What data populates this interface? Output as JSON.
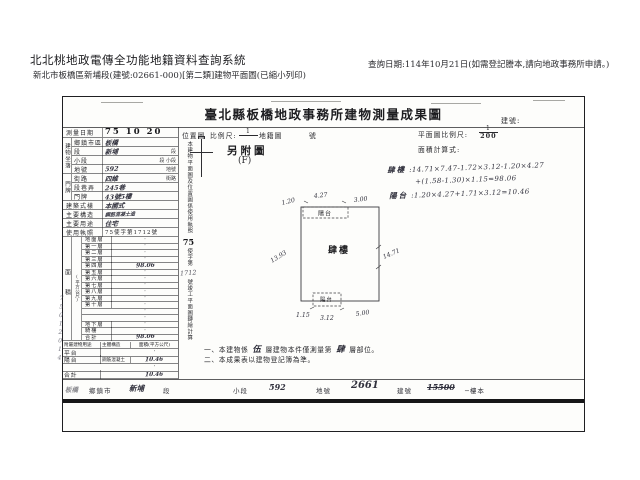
{
  "header": {
    "system_title": "北北桃地政電傳全功能地籍資料查詢系統",
    "print_info": "新北市板橋區新埔段(建號:02661-000)[第二類]建物平面圖(已縮小列印)",
    "query_date": "查詢日期:114年10月21日(如需登記謄本,請向地政事務所申請。)"
  },
  "doc": {
    "title": "臺北縣板橋地政事務所建物測量成果圖",
    "building_no_label": "建號:",
    "survey": {
      "label": "測量日期",
      "value": "75 10 20"
    },
    "location": {
      "group_label": "建物坐落",
      "rows": [
        {
          "label": "鄉鎮市區",
          "value": "板橋",
          "suffix": ""
        },
        {
          "label": "段",
          "value": "新埔",
          "suffix": "段"
        },
        {
          "label": "小段",
          "value": "",
          "suffix": "段 小段"
        },
        {
          "label": "地號",
          "value": "592",
          "suffix": "地號"
        }
      ]
    },
    "address": {
      "group_label": "門牌",
      "rows": [
        {
          "label": "街路",
          "value": "四維",
          "suffix": "街路"
        },
        {
          "label": "段巷弄",
          "value": "245巷",
          "suffix": ""
        },
        {
          "label": "門牌",
          "value": "43號5樓",
          "suffix": ""
        }
      ]
    },
    "building": [
      {
        "label": "建築式樣",
        "value": "本國式"
      },
      {
        "label": "主要構造",
        "value": "鋼筋混凝土造"
      },
      {
        "label": "主要用途",
        "value": "住宅"
      },
      {
        "label": "使用執照",
        "value": "75使字第1712號"
      }
    ],
    "area": {
      "group_label": "面積",
      "unit_label": "(平方公尺)",
      "rows": [
        {
          "label": "地面層",
          "value": "·"
        },
        {
          "label": "第一層",
          "value": "·"
        },
        {
          "label": "第二層",
          "value": "·"
        },
        {
          "label": "第三層",
          "value": "·"
        },
        {
          "label": "第四層",
          "value": "98.06"
        },
        {
          "label": "第五層",
          "value": "·"
        },
        {
          "label": "第六層",
          "value": "·"
        },
        {
          "label": "第七層",
          "value": "·"
        },
        {
          "label": "第八層",
          "value": "·"
        },
        {
          "label": "第九層",
          "value": "·"
        },
        {
          "label": "第十層",
          "value": "·"
        },
        {
          "label": "",
          "value": "·"
        },
        {
          "label": "",
          "value": "·"
        },
        {
          "label": "地下層",
          "value": "·"
        },
        {
          "label": "騎樓",
          "value": "·"
        },
        {
          "label": "合計",
          "value": "98.06"
        }
      ]
    },
    "annex": {
      "headers": [
        "附屬建物用途",
        "主體構造",
        "面積(平方公尺)"
      ],
      "rows": [
        {
          "use": "平台",
          "structure": "",
          "area": "·"
        },
        {
          "use": "陽台",
          "structure": "鋼筋混凝土",
          "area": "10.46"
        },
        {
          "use": "",
          "structure": "",
          "area": "·"
        },
        {
          "use": "合計",
          "structure": "",
          "area": "10.46"
        }
      ]
    },
    "margin_note": "75012014",
    "strip_note": {
      "pre": "本建物平面圖及位置圖係使用執照",
      "num_bold": "75",
      "mid": "使字第",
      "hand": "1712",
      "post": "號竣工平面圖轉繪計算"
    },
    "map_header": {
      "location_label": "位置圖",
      "scale_label": "比例尺:",
      "scale_num": "1",
      "cadastral_label": "地籍圖",
      "no_label": "號",
      "plan_scale_label": "平面圖比例尺:",
      "plan_num": "1",
      "plan_den": "200",
      "calc_label": "面積計算式:",
      "attached": "另附圖",
      "attached_sub": "(F)"
    },
    "calc": {
      "l1_name": "肆樓",
      "l1": ":14.71×7.47-1.72×3.12-1.20×4.27",
      "l2": "+(1.58-1.30)×1.15=98.06",
      "l3_name": "陽台",
      "l3": ":1.20×4.27+1.71×3.12=10.46"
    },
    "diagram": {
      "main_label": "肆樓",
      "balcony_top": "陽台",
      "balcony_bottom": "陽台",
      "dim_top": "4.27",
      "dim_top_right": "3.00",
      "dim_top_left": "1.20",
      "dim_left": "13.93",
      "dim_right": "14.71",
      "dim_b_left": "1.15",
      "dim_b_mid": "3.12",
      "dim_b_right": "5.00"
    },
    "notes": {
      "n1_pre": "一、本建物係",
      "n1_hand1": "伍",
      "n1_mid": "層建物本件僅測量第",
      "n1_hand2": "肆",
      "n1_post": "層部位。",
      "n2": "二、本成果表以建物登記簿為準。"
    },
    "bottom": {
      "county": "板橋",
      "township_label": "鄉鎮市",
      "section": "新埔",
      "section_label": "段",
      "subsection_label": "小段",
      "parcel": "592",
      "parcel_label": "地號",
      "bno": "2661",
      "bno_label": "建號",
      "bno_old": "15500",
      "tail": "─樓本"
    }
  }
}
